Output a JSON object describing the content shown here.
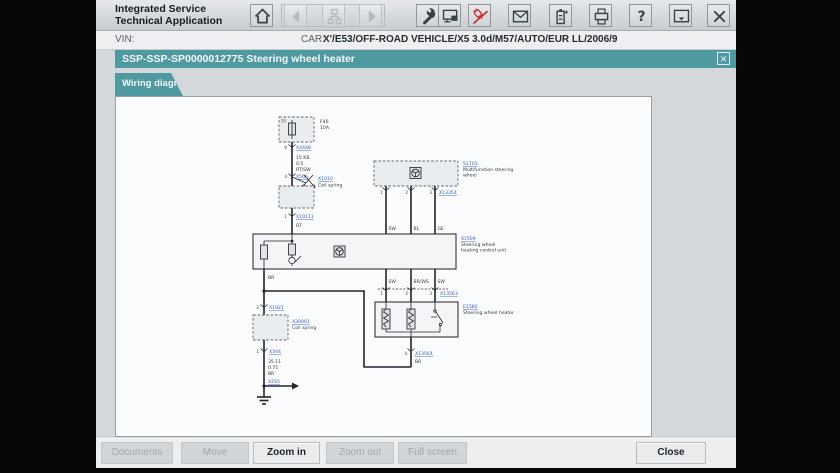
{
  "colors": {
    "accent_teal": "#4f99a1",
    "link_blue": "#3b5fc4",
    "alert_red": "#c23030"
  },
  "header": {
    "app_title_line1": "Integrated Service",
    "app_title_line2": "Technical Application",
    "toolbar_icons": [
      "home",
      "back",
      "sitemap",
      "forward",
      "wrench",
      "workshop-info",
      "vehicle-connection",
      "mail",
      "battery",
      "printer",
      "help",
      "minimize-panel",
      "close"
    ]
  },
  "vin_bar": {
    "vin_label": "VIN:",
    "car_label": "CAR:",
    "car_value": "X'/E53/OFF-ROAD VEHICLE/X5 3.0d/M57/AUTO/EUR LL/2006/9"
  },
  "doc_bar": {
    "title": "SSP-SSP-SP0000012775 Steering wheel heater",
    "close_glyph": "✕"
  },
  "tabs": {
    "wiring": "Wiring diagram"
  },
  "footer": {
    "buttons": [
      {
        "label": "Documents",
        "enabled": false
      },
      {
        "label": "Move",
        "enabled": false
      },
      {
        "label": "Zoom in",
        "enabled": true
      },
      {
        "label": "Zoom out",
        "enabled": false
      },
      {
        "label": "Full screen",
        "enabled": false
      },
      {
        "label": "Close",
        "enabled": true
      }
    ]
  },
  "diagram": {
    "fuse": {
      "pin": "30",
      "name": "F46",
      "rating": "10A"
    },
    "conn_a": {
      "pin": "9",
      "code": "X4448"
    },
    "wire_a": {
      "l1": "15 KB",
      "l2": "0.5",
      "l3": "RT/SW"
    },
    "conn_b": {
      "pin": "4",
      "code": "X566"
    },
    "cut": {
      "code": "X1010",
      "label": "Coil spring"
    },
    "conn_c": {
      "pin": "1",
      "code": "X10111"
    },
    "wire_b": "RT",
    "ctrl": {
      "code": "S1509",
      "line1": "Steering wheel",
      "line2": "heating control unit"
    },
    "mfl": {
      "code": "S1703",
      "line1": "Multifunction steering",
      "line2": "wheel",
      "pins": [
        "1",
        "2",
        "3"
      ],
      "conn_code": "X13354",
      "wires": [
        "SW",
        "BL",
        "GE"
      ]
    },
    "mid": {
      "pins": [
        "1",
        "2",
        "3"
      ],
      "conn_code": "X13563",
      "wires": [
        "SW",
        "BR/WS",
        "SW"
      ]
    },
    "heater": {
      "code": "E1580",
      "label": "Steering wheel heater"
    },
    "conn_d": {
      "pin": "4",
      "code": "X13564",
      "wire": "BR"
    },
    "wire_c": "BR",
    "conn_e": {
      "pin": "2",
      "code": "X1921"
    },
    "coil": {
      "code": "X30001",
      "label": "Coil spring"
    },
    "conn_f": {
      "pin": "1",
      "code": "X344"
    },
    "wire_d": {
      "l1": "35.11",
      "l2": "0.75",
      "l3": "BR"
    },
    "ground": {
      "code": "X255"
    }
  }
}
